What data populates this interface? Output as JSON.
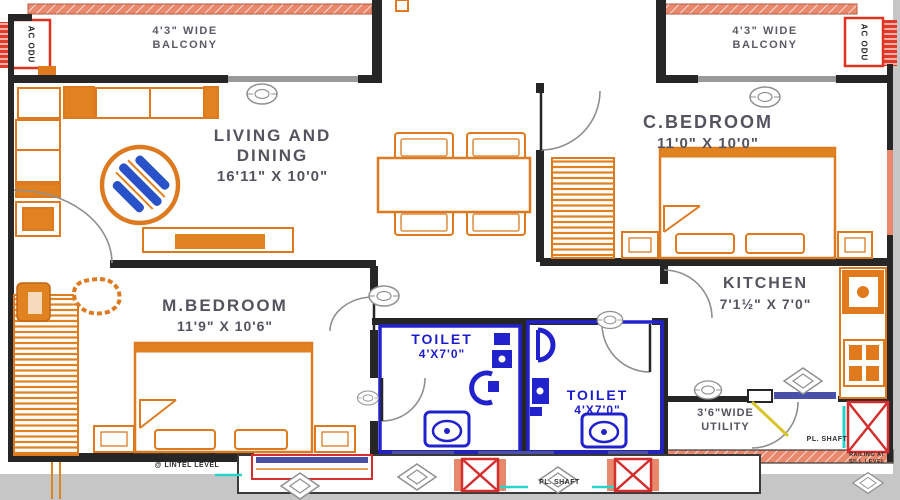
{
  "balconies": {
    "left": {
      "line1": "4'3\" WIDE",
      "line2": "BALCONY"
    },
    "right": {
      "line1": "4'3\" WIDE",
      "line2": "BALCONY"
    }
  },
  "ac_units": {
    "left": "AC ODU",
    "right": "AC ODU"
  },
  "rooms": {
    "living_dining": {
      "name_line1": "LIVING AND",
      "name_line2": "DINING",
      "dims": "16'11\" X 10'0\""
    },
    "c_bedroom": {
      "name": "C.BEDROOM",
      "dims": "11'0\" X 10'0\""
    },
    "m_bedroom": {
      "name": "M.BEDROOM",
      "dims": "11'9\" X 10'6\""
    },
    "kitchen": {
      "name": "KITCHEN",
      "dims": "7'1½\" X 7'0\""
    },
    "toilet_1": {
      "name": "TOILET",
      "dims": "4'X7'0\""
    },
    "toilet_2": {
      "name": "TOILET",
      "dims": "4'X7'0\""
    },
    "utility": {
      "line1": "3'6\"WIDE",
      "line2": "UTILITY"
    }
  },
  "annotations": {
    "pl_shaft_bottom": "PL. SHAFT",
    "pl_shaft_utility": "PL. SHAFT",
    "chajja_line1": "CHAJJA HIGHT",
    "chajja_line2": "@ LINTEL LEVEL",
    "railing_line1": "RAILING AT",
    "railing_line2": "SILL LEVEL"
  },
  "colors": {
    "wall_black": "#262626",
    "furniture_orange": "#dd7a1f",
    "exterior_salmon": "#e8886c",
    "toilet_blue": "#2222cc",
    "label_text": "#54545f",
    "ac_red": "#e03222",
    "shaft_red": "#d32f2f",
    "window_gray": "#999999",
    "window_blue": "#4a4fa8",
    "accent_teal": "#25d5cc",
    "accent_yellow": "#d8c52a",
    "background_gray": "#c6c6c6"
  }
}
